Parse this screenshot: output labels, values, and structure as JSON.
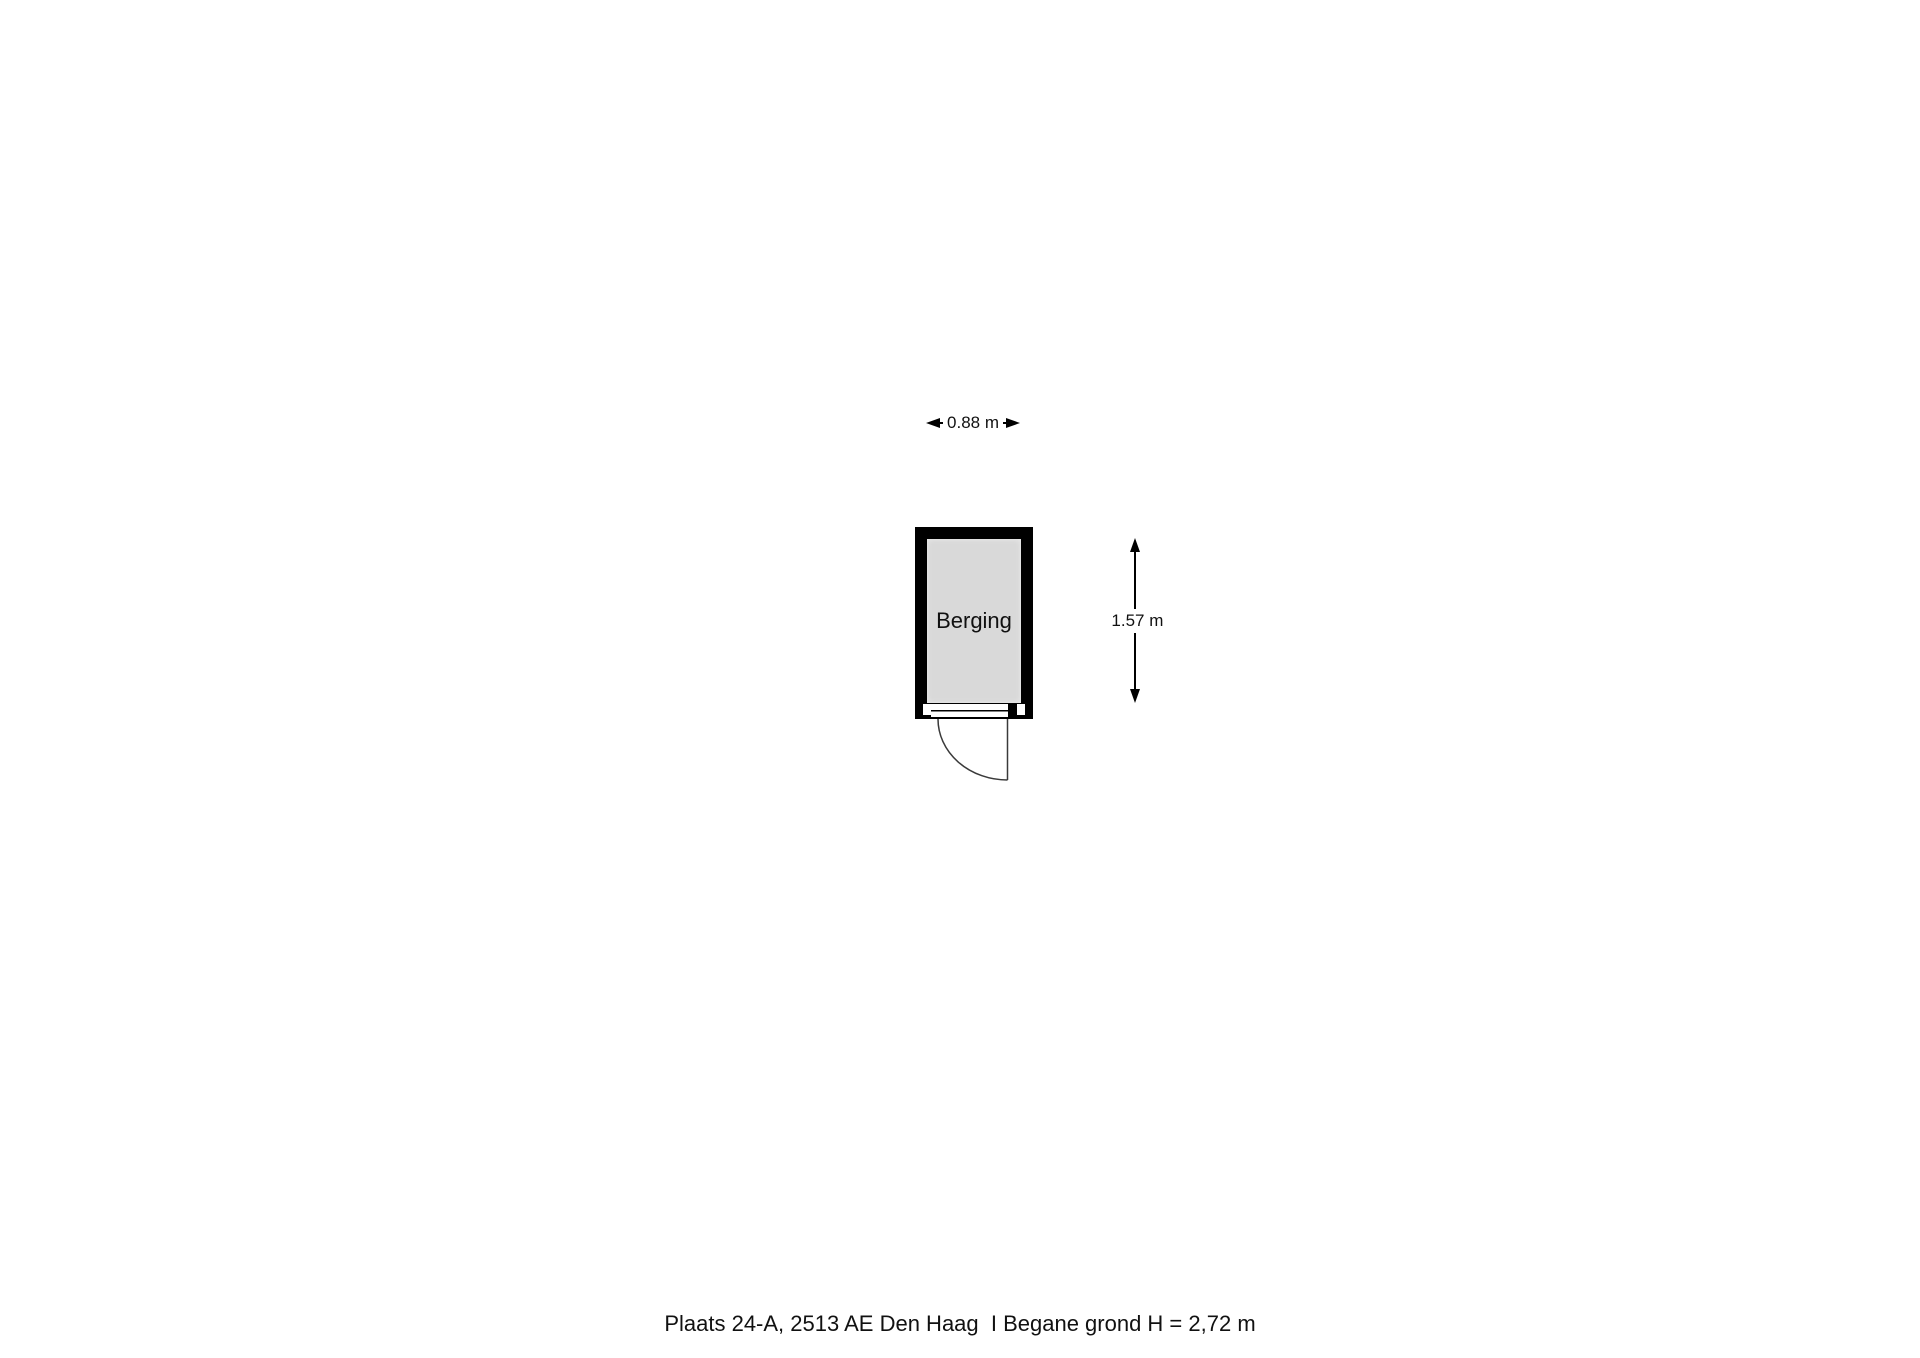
{
  "plan": {
    "room": {
      "label": "Berging"
    },
    "dimensions": {
      "width_label": "0.88 m",
      "height_label": "1.57 m"
    },
    "door": {
      "type": "hinged-door-90deg-swing"
    }
  },
  "footer": {
    "caption": "Plaats 24-A, 2513 AE Den Haag  I Begane grond H = 2,72 m"
  },
  "colors": {
    "wall": "#000000",
    "floor_fill": "#d9d9d9",
    "door_line": "#3a3a3a",
    "text": "#111111"
  }
}
